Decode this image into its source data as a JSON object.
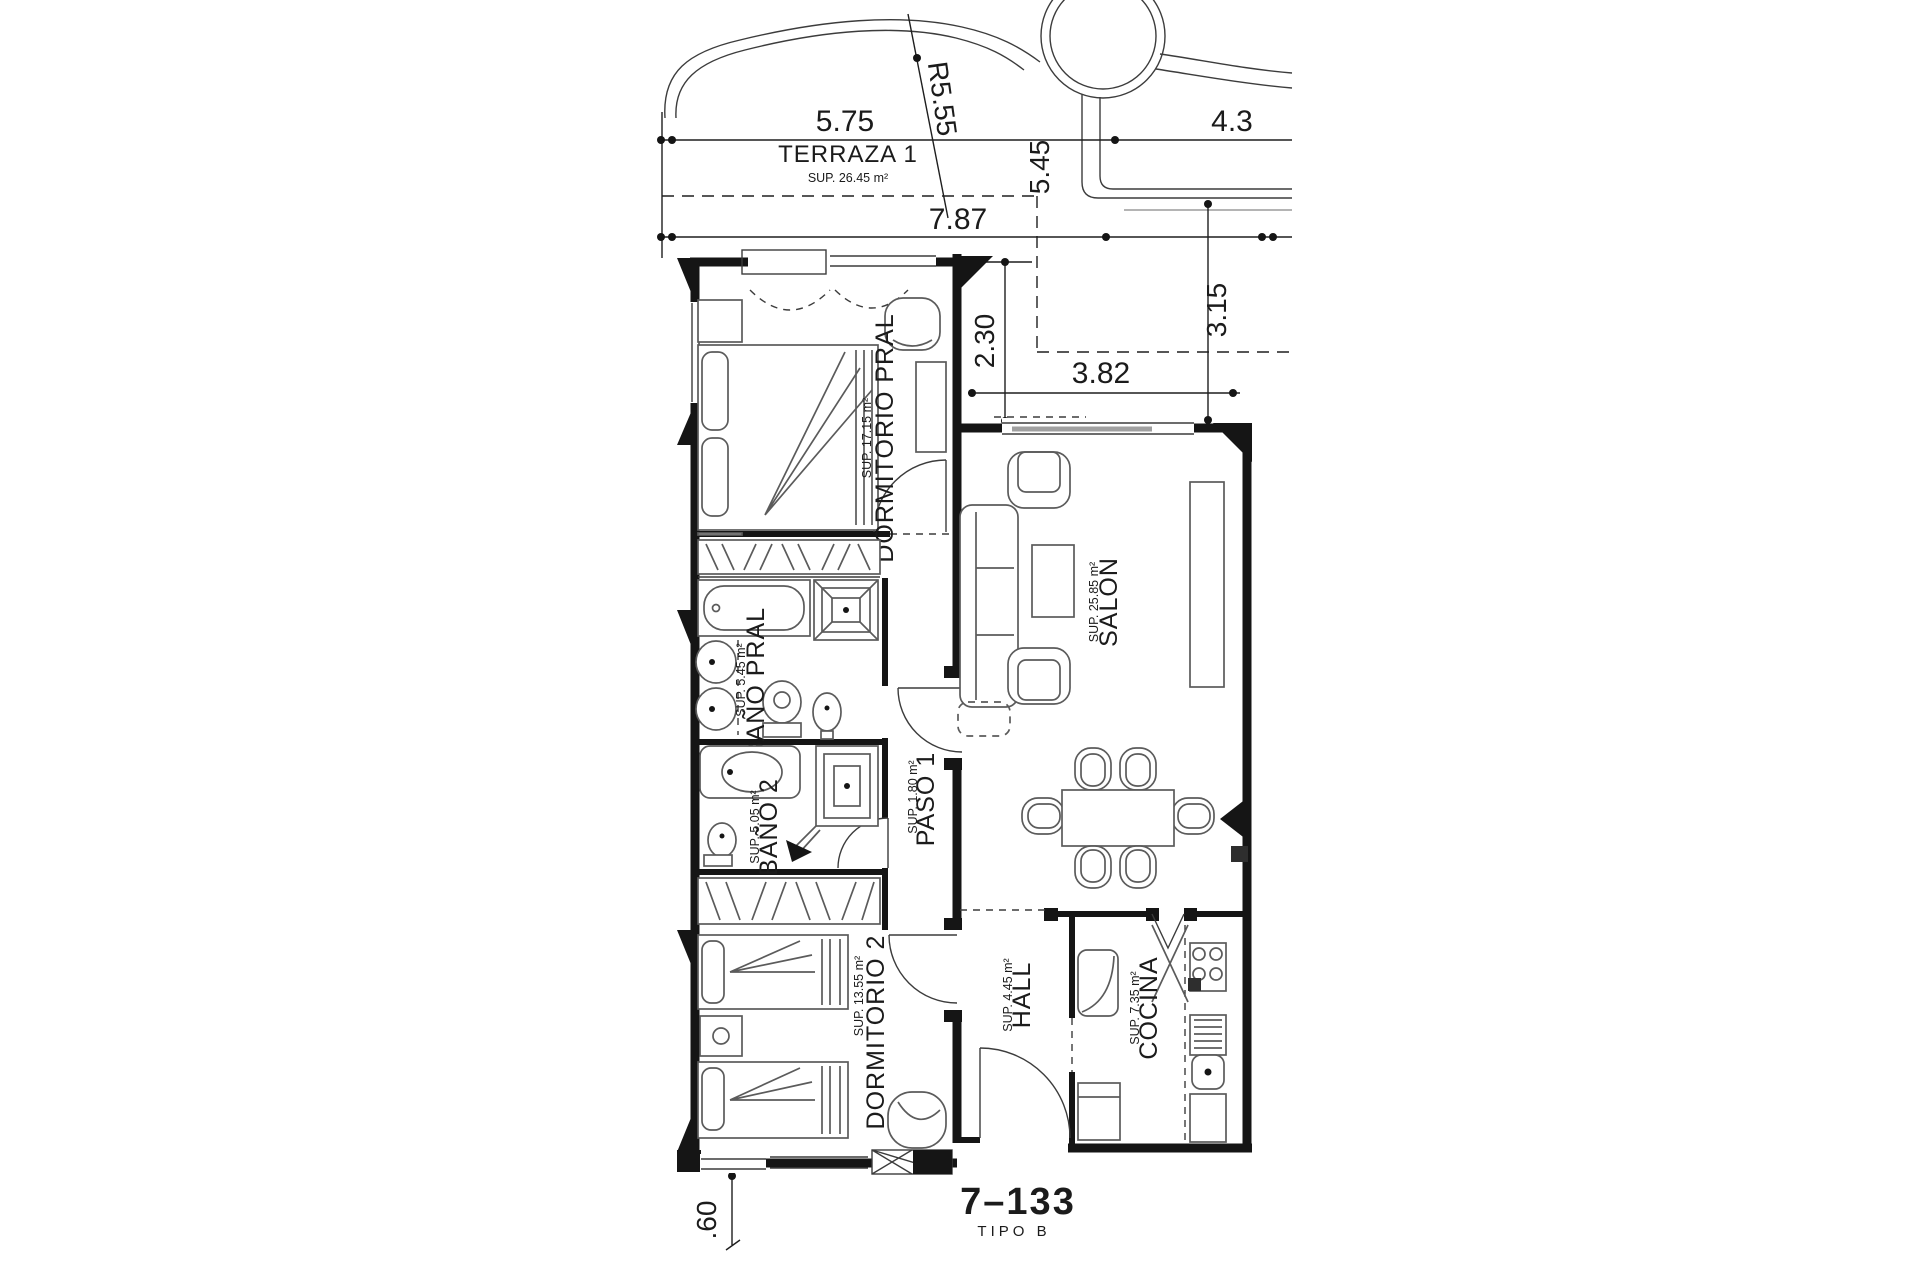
{
  "drawing": {
    "number": "7–133",
    "type_label": "TIPO B"
  },
  "rooms": [
    {
      "name": "TERRAZA 1",
      "area": "SUP. 26.45 m²"
    },
    {
      "name": "DORMITORIO PRAL",
      "area": "SUP. 17.15 m²"
    },
    {
      "name": "BAÑO PRAL",
      "area": "SUP. 5.45 m²"
    },
    {
      "name": "BAÑO 2",
      "area": "SUP. 5.05 m²"
    },
    {
      "name": "PASO 1",
      "area": "SUP. 1.80 m²"
    },
    {
      "name": "SALON",
      "area": "SUP. 25.85 m²"
    },
    {
      "name": "DORMITORIO 2",
      "area": "SUP. 13.55 m²"
    },
    {
      "name": "HALL",
      "area": "SUP. 4.45 m²"
    },
    {
      "name": "COCINA",
      "area": "SUP. 7.35 m²"
    }
  ],
  "dimensions": {
    "terrace_width": "5.75",
    "right_width": "4.3",
    "radius": "R5.55",
    "terrace_depth": "5.45",
    "total_width": "7.87",
    "upper_offset": "2.30",
    "salon_front": "3.82",
    "salon_side": "3.15",
    "step": ".60"
  },
  "colors": {
    "ink": "#151515",
    "background": "#ffffff",
    "glazing_gray": "#a0a0a0"
  }
}
